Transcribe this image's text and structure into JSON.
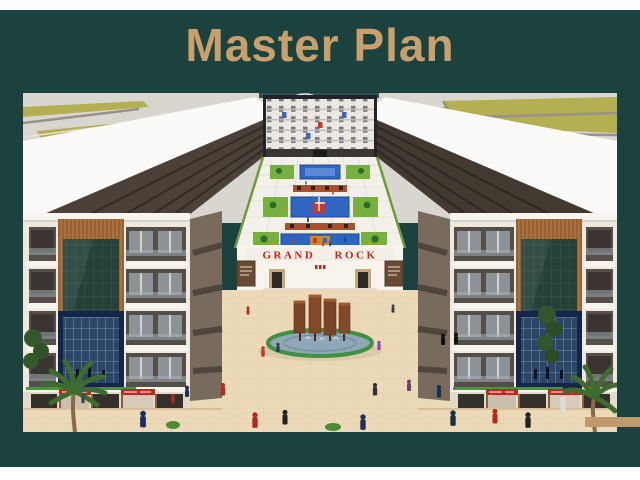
{
  "slide": {
    "title": "Master Plan",
    "colors": {
      "page_background": "#ffffff",
      "panel_green": "#1b423e",
      "title_tan": "#c9a06c",
      "accent_bar_tan": "#bf9a6a",
      "sign_red": "#c2271d"
    }
  },
  "render": {
    "entrance_sign": "GRAND ROCK"
  }
}
